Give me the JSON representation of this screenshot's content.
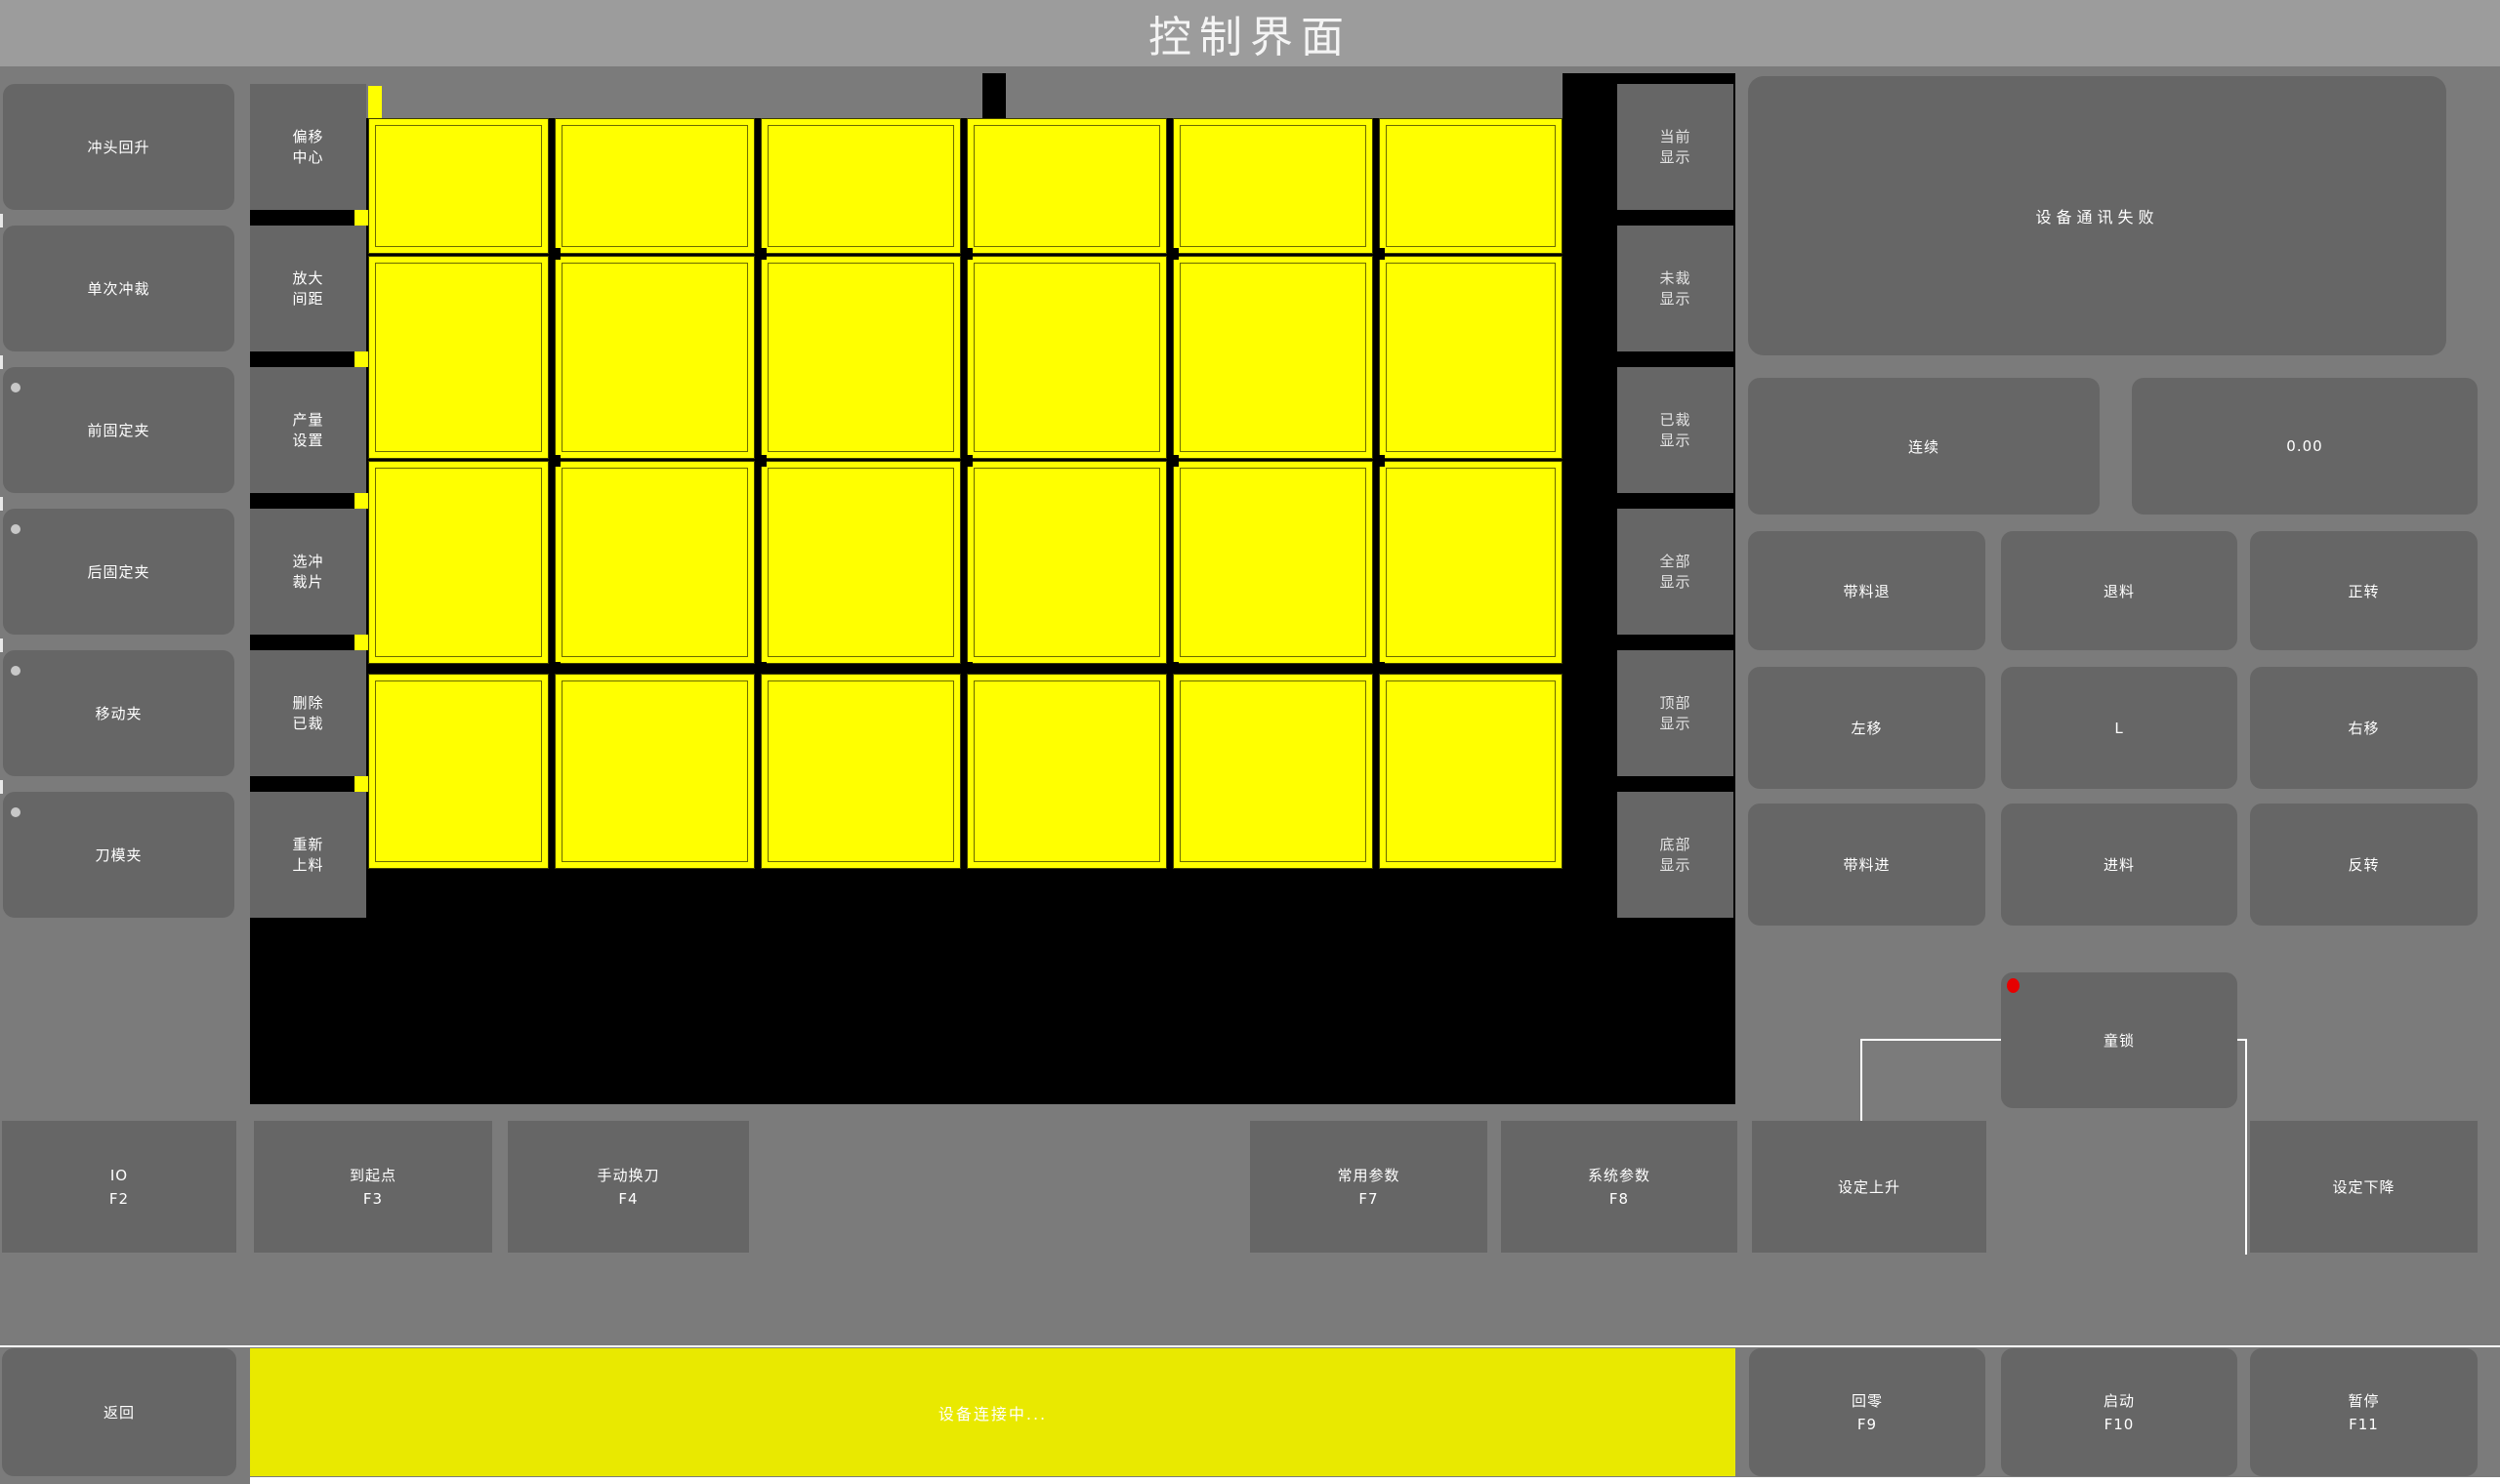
{
  "title": "控制界面",
  "left_column": {
    "buttons": [
      {
        "label": "冲头回升",
        "dot": false
      },
      {
        "label": "单次冲裁",
        "dot": false
      },
      {
        "label": "前固定夹",
        "dot": true
      },
      {
        "label": "后固定夹",
        "dot": true
      },
      {
        "label": "移动夹",
        "dot": true
      },
      {
        "label": "刀模夹",
        "dot": true
      }
    ]
  },
  "canvas_column": {
    "buttons": [
      {
        "lines": [
          "偏移",
          "中心"
        ]
      },
      {
        "lines": [
          "放大",
          "间距"
        ]
      },
      {
        "lines": [
          "产量",
          "设置"
        ]
      },
      {
        "lines": [
          "选冲",
          "裁片"
        ]
      },
      {
        "lines": [
          "删除",
          "已裁"
        ]
      },
      {
        "lines": [
          "重新",
          "上料"
        ]
      }
    ]
  },
  "display_column": {
    "buttons": [
      {
        "lines": [
          "当前",
          "显示"
        ]
      },
      {
        "lines": [
          "未裁",
          "显示"
        ]
      },
      {
        "lines": [
          "已裁",
          "显示"
        ]
      },
      {
        "lines": [
          "全部",
          "显示"
        ]
      },
      {
        "lines": [
          "顶部",
          "显示"
        ]
      },
      {
        "lines": [
          "底部",
          "显示"
        ]
      }
    ]
  },
  "canvas": {
    "description": "nesting layout of cut pieces",
    "grid_cols": 6,
    "grid_rows": 4,
    "tile_color": "#ffff00",
    "background": "#000000"
  },
  "right_panel": {
    "message": "设备通讯失败",
    "mode_button": "连续",
    "value_display": "0.00",
    "jog_buttons": [
      [
        "带料退",
        "退料",
        "正转"
      ],
      [
        "左移",
        "L",
        "右移"
      ],
      [
        "带料进",
        "进料",
        "反转"
      ]
    ],
    "child_lock": {
      "label": "童锁",
      "indicator_color": "#e60000"
    }
  },
  "function_row": {
    "buttons": [
      {
        "label": "IO",
        "fkey": "F2"
      },
      {
        "label": "到起点",
        "fkey": "F3"
      },
      {
        "label": "手动换刀",
        "fkey": "F4"
      },
      {
        "label": "常用参数",
        "fkey": "F7"
      },
      {
        "label": "系统参数",
        "fkey": "F8"
      },
      {
        "label": "设定上升",
        "fkey": ""
      },
      {
        "label": "设定下降",
        "fkey": ""
      }
    ]
  },
  "bottom_bar": {
    "back": "返回",
    "status": "设备连接中...",
    "status_color": "#e9e900",
    "buttons": [
      {
        "label": "回零",
        "fkey": "F9"
      },
      {
        "label": "启动",
        "fkey": "F10"
      },
      {
        "label": "暂停",
        "fkey": "F11"
      }
    ]
  },
  "colors": {
    "background": "#7b7b7b",
    "titlebar": "#9c9c9c",
    "button": "#666666",
    "canvas_black": "#000000",
    "tile_yellow": "#ffff00",
    "status_yellow": "#e9e900",
    "red_indicator": "#e60000"
  }
}
